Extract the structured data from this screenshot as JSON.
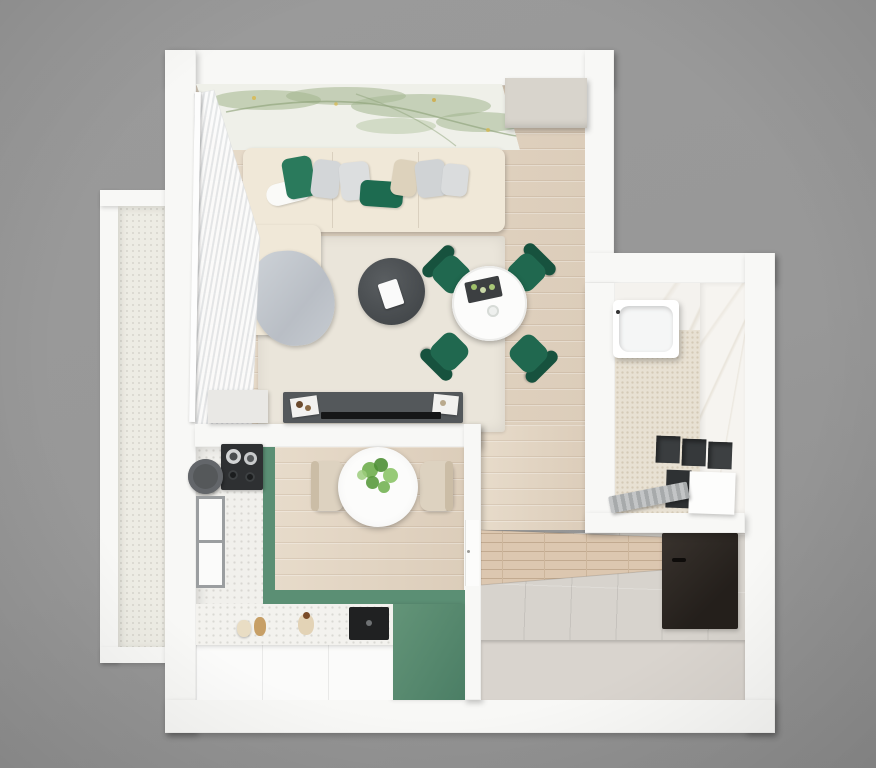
{
  "scene": {
    "title": "3D top-down floor plan of a one-bedroom apartment",
    "style": "photorealistic render on gray background"
  },
  "colors": {
    "background_gray": "#9a9a9a",
    "wall_white": "#f8f8f6",
    "wood_floor": "#e3d6c6",
    "rug_cream": "#eae5da",
    "sofa_beige": "#f0e8d8",
    "pillow_green": "#2a7a5c",
    "pillow_green_dark": "#1d6b50",
    "pillow_gray": "#d3d6d8",
    "pillow_beige": "#ddd2bc",
    "blanket_gray": "#c6cbd1",
    "coffee_table_dark": "#4b4f52",
    "console_dark": "#54585b",
    "tv_black": "#151617",
    "dining_white": "#fcfcfb",
    "chair_green": "#20684f",
    "chair_green_dark": "#17523e",
    "counter_green": "#5b8f74",
    "terrazzo_white": "#f1f0ec",
    "cabinet_white": "#fbfbfa",
    "sink_black": "#202122",
    "tile_gray": "#d7d3cd",
    "hall_wall_beige": "#d9d4ce",
    "wardrobe_dark": "#2c2723",
    "bath_marble": "#f4f2ee",
    "mosaic_beige": "#e8e1d3",
    "fixture_dark": "#3a3d3f",
    "balcony_floor": "#edece4",
    "chair_beige": "#ddd2c0",
    "plant_green": "#6fae4e",
    "mural_bg": "#eff0e9",
    "mural_green": "#a9bb97",
    "closet_beige": "#d8d4cc"
  },
  "rooms": {
    "living_room": "Living room with sofa, rug, coffee table and dining set",
    "kitchen": "Kitchen with green L-shaped cabinets and breakfast table",
    "bathroom": "Bathroom with bathtub and vanity",
    "hallway": "Hallway with dark wardrobe",
    "balcony": "Balcony",
    "corridor": "Corridor"
  },
  "objects": {
    "sofa": "Beige corner sofa with green and gray pillows",
    "blanket": "Gray throw blanket",
    "rug": "Cream area rug",
    "coffee_table": "Round dark coffee table with book",
    "dining_table": "Round white dining table",
    "dining_chair": "Green velvet dining chair",
    "tv_console": "Dark TV console with decor trays",
    "tv": "Flat TV",
    "closet": "Built-in closet",
    "curtain": "Sheer white curtain",
    "mural": "Botanical wall mural",
    "kitchen_table": "Round white kitchen table with plant",
    "kitchen_chair": "Beige kitchen chair",
    "hob": "Cooktop with pots",
    "round_sink": "Round dark sink",
    "kitchen_sink": "Black square sink",
    "window": "Kitchen window",
    "bathtub": "White bathtub",
    "shelves": "Dark wall shelf boxes",
    "vanity": "Bathroom vanity cabinets",
    "radiator": "Gray radiator",
    "hall_wardrobe": "Dark entry wardrobe"
  }
}
